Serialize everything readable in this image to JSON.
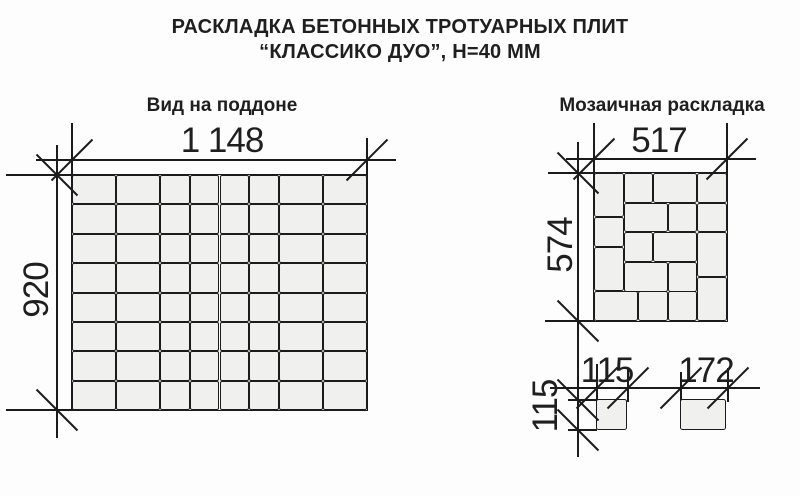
{
  "title": {
    "line1": "РАСКЛАДКА БЕТОННЫХ ТРОТУАРНЫХ ПЛИТ",
    "line2": "“КЛАССИКО ДУО”, Н=40 ММ"
  },
  "pallet_view": {
    "heading": "Вид на поддоне",
    "width_label": "1 148",
    "height_label": "920",
    "width_mm": 1148,
    "height_mm": 920,
    "columns_mm": [
      172,
      172,
      115,
      115,
      115,
      115,
      172,
      172
    ],
    "rows_mm": [
      115,
      115,
      115,
      115,
      115,
      115,
      115,
      115
    ]
  },
  "mosaic_view": {
    "heading": "Мозаичная раскладка",
    "width_label": "517",
    "height_label": "574",
    "width_mm": 517,
    "height_mm": 574,
    "tiles_mm": [
      {
        "x": 0,
        "y": 0,
        "w": 115,
        "h": 172
      },
      {
        "x": 115,
        "y": 0,
        "w": 115,
        "h": 115
      },
      {
        "x": 230,
        "y": 0,
        "w": 172,
        "h": 115
      },
      {
        "x": 402,
        "y": 0,
        "w": 115,
        "h": 115
      },
      {
        "x": 115,
        "y": 115,
        "w": 172,
        "h": 115
      },
      {
        "x": 287,
        "y": 115,
        "w": 115,
        "h": 115
      },
      {
        "x": 402,
        "y": 115,
        "w": 115,
        "h": 115
      },
      {
        "x": 0,
        "y": 172,
        "w": 115,
        "h": 115
      },
      {
        "x": 402,
        "y": 230,
        "w": 115,
        "h": 172
      },
      {
        "x": 115,
        "y": 230,
        "w": 115,
        "h": 115
      },
      {
        "x": 230,
        "y": 230,
        "w": 172,
        "h": 115
      },
      {
        "x": 0,
        "y": 287,
        "w": 115,
        "h": 172
      },
      {
        "x": 115,
        "y": 345,
        "w": 172,
        "h": 115
      },
      {
        "x": 287,
        "y": 345,
        "w": 115,
        "h": 115
      },
      {
        "x": 402,
        "y": 402,
        "w": 115,
        "h": 172
      },
      {
        "x": 0,
        "y": 459,
        "w": 172,
        "h": 115
      },
      {
        "x": 172,
        "y": 459,
        "w": 115,
        "h": 115
      },
      {
        "x": 287,
        "y": 459,
        "w": 115,
        "h": 115
      }
    ]
  },
  "single_tiles": [
    {
      "width_label": "115",
      "height_label": "115",
      "w_mm": 115,
      "h_mm": 115
    },
    {
      "width_label": "172",
      "w_mm": 172,
      "h_mm": 115
    }
  ],
  "colors": {
    "line": "#1b1b1b",
    "tile_fill": "#f0f0ef",
    "background": "#fdfdfd",
    "text": "#1f1f1f"
  }
}
